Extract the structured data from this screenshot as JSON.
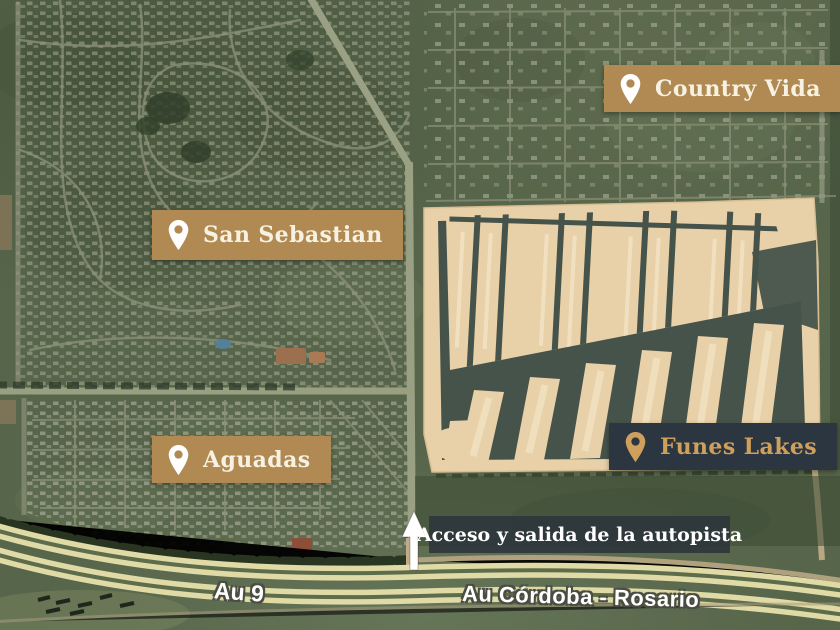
{
  "map": {
    "type": "satellite-aerial",
    "neighborhood_labels": [
      {
        "id": "country-vida",
        "name": "Country Vida",
        "variant": "gold",
        "icon": "location-pin"
      },
      {
        "id": "san-sebastian",
        "name": "San Sebastian",
        "variant": "gold",
        "icon": "location-pin"
      },
      {
        "id": "aguadas",
        "name": "Aguadas",
        "variant": "gold",
        "icon": "location-pin"
      },
      {
        "id": "funes-lakes",
        "name": "Funes Lakes",
        "variant": "dark",
        "icon": "location-pin"
      }
    ],
    "annotation": {
      "text": "Acceso y salida de la autopista",
      "icon": "up-arrow"
    },
    "road_labels": [
      {
        "id": "au-9",
        "text": "Au 9"
      },
      {
        "id": "au-cordoba-rosario",
        "text": "Au Córdoba - Rosario"
      }
    ]
  },
  "colors": {
    "label_gold_bg": "#b08a52",
    "label_dark_bg": "#2b3640",
    "label_text_light": "#f7f1e2",
    "label_text_gold": "#cf9f5c",
    "annotation_bg": "#2c343a",
    "arrow": "#ffffff",
    "road_label_text": "#ffffff",
    "terrain_green": "#57654a",
    "development_sand": "#e8d0a8",
    "water_channel": "#46534b",
    "highway_lane": "#e0daa6"
  }
}
